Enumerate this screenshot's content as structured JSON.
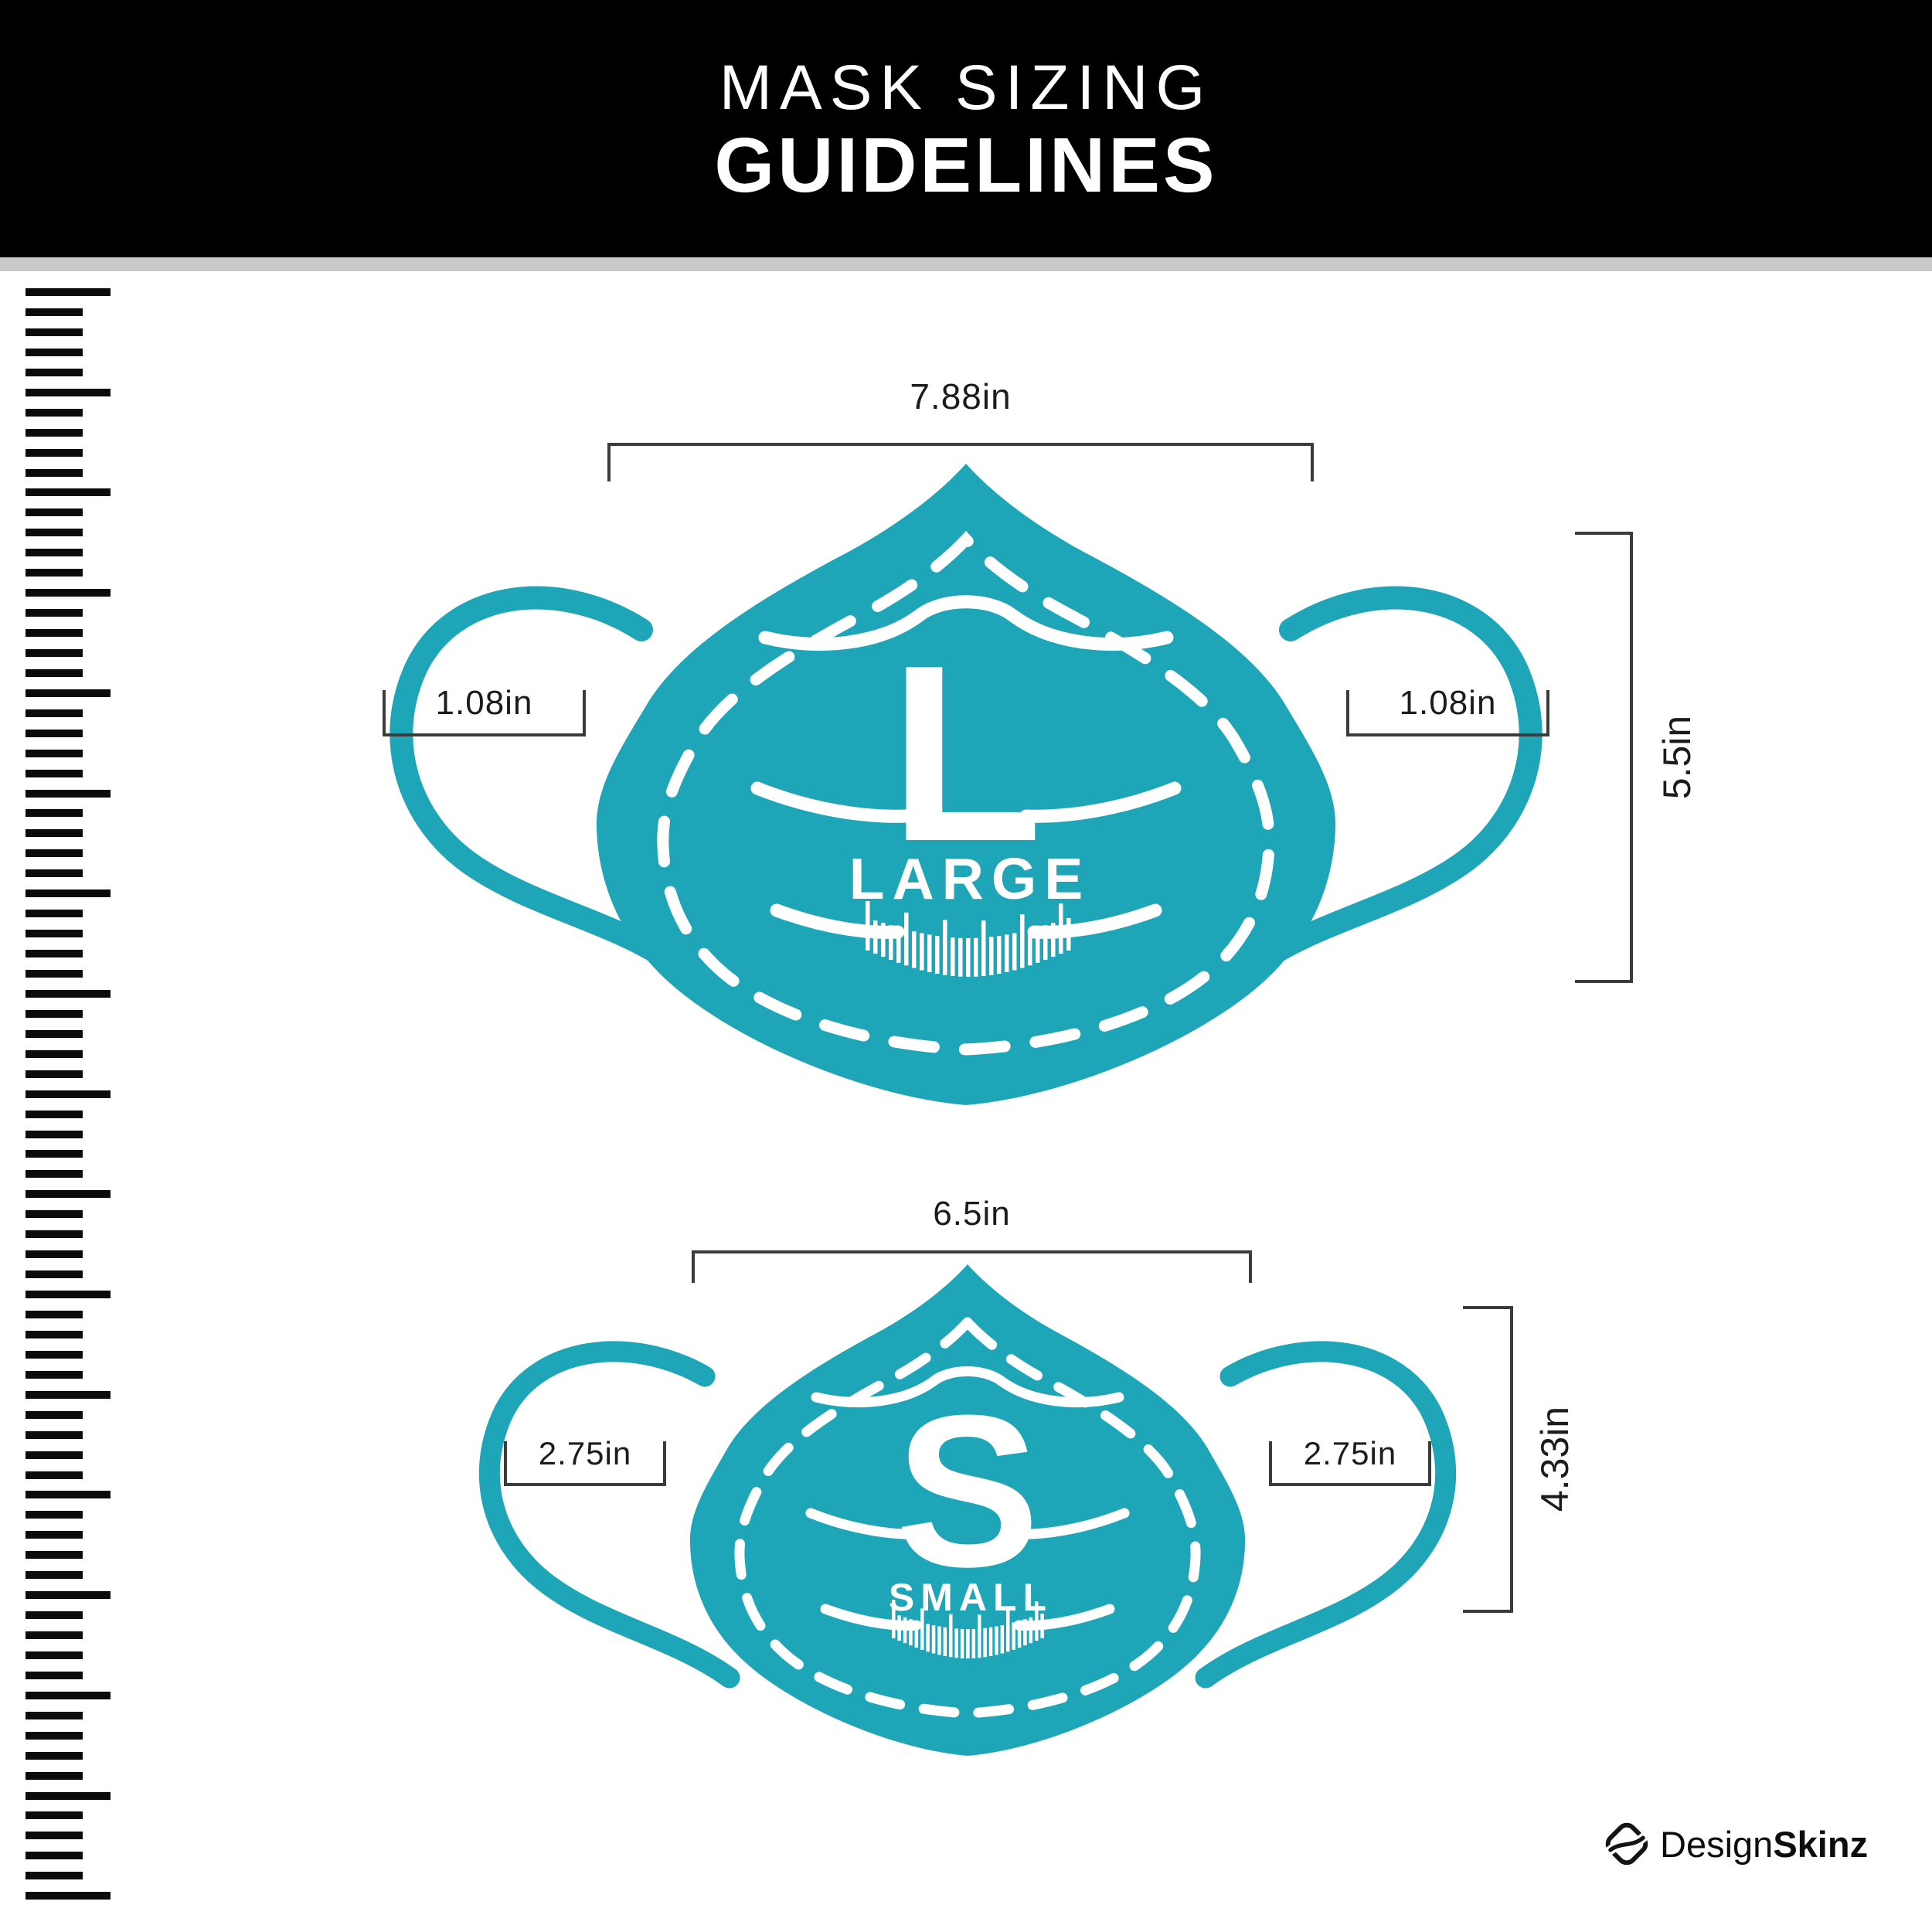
{
  "header": {
    "title_line1": "MASK SIZING",
    "title_line2": "GUIDELINES"
  },
  "masks": [
    {
      "letter": "L",
      "size_label": "LARGE",
      "top_width": "7.88in",
      "ear_left": "1.08in",
      "ear_right": "1.08in",
      "height": "5.5in"
    },
    {
      "letter": "S",
      "size_label": "SMALL",
      "top_width": "6.5in",
      "ear_left": "2.75in",
      "ear_right": "2.75in",
      "height": "4.33in"
    }
  ],
  "footer": {
    "brand_regular": "Design",
    "brand_bold": "Skinz"
  },
  "colors": {
    "mask_teal": "#1ea6b8",
    "header_bg": "#000000",
    "divider_gray": "#c9c9c9",
    "bracket_line": "#3c3c3c",
    "text_ink": "#1c1c1c"
  }
}
